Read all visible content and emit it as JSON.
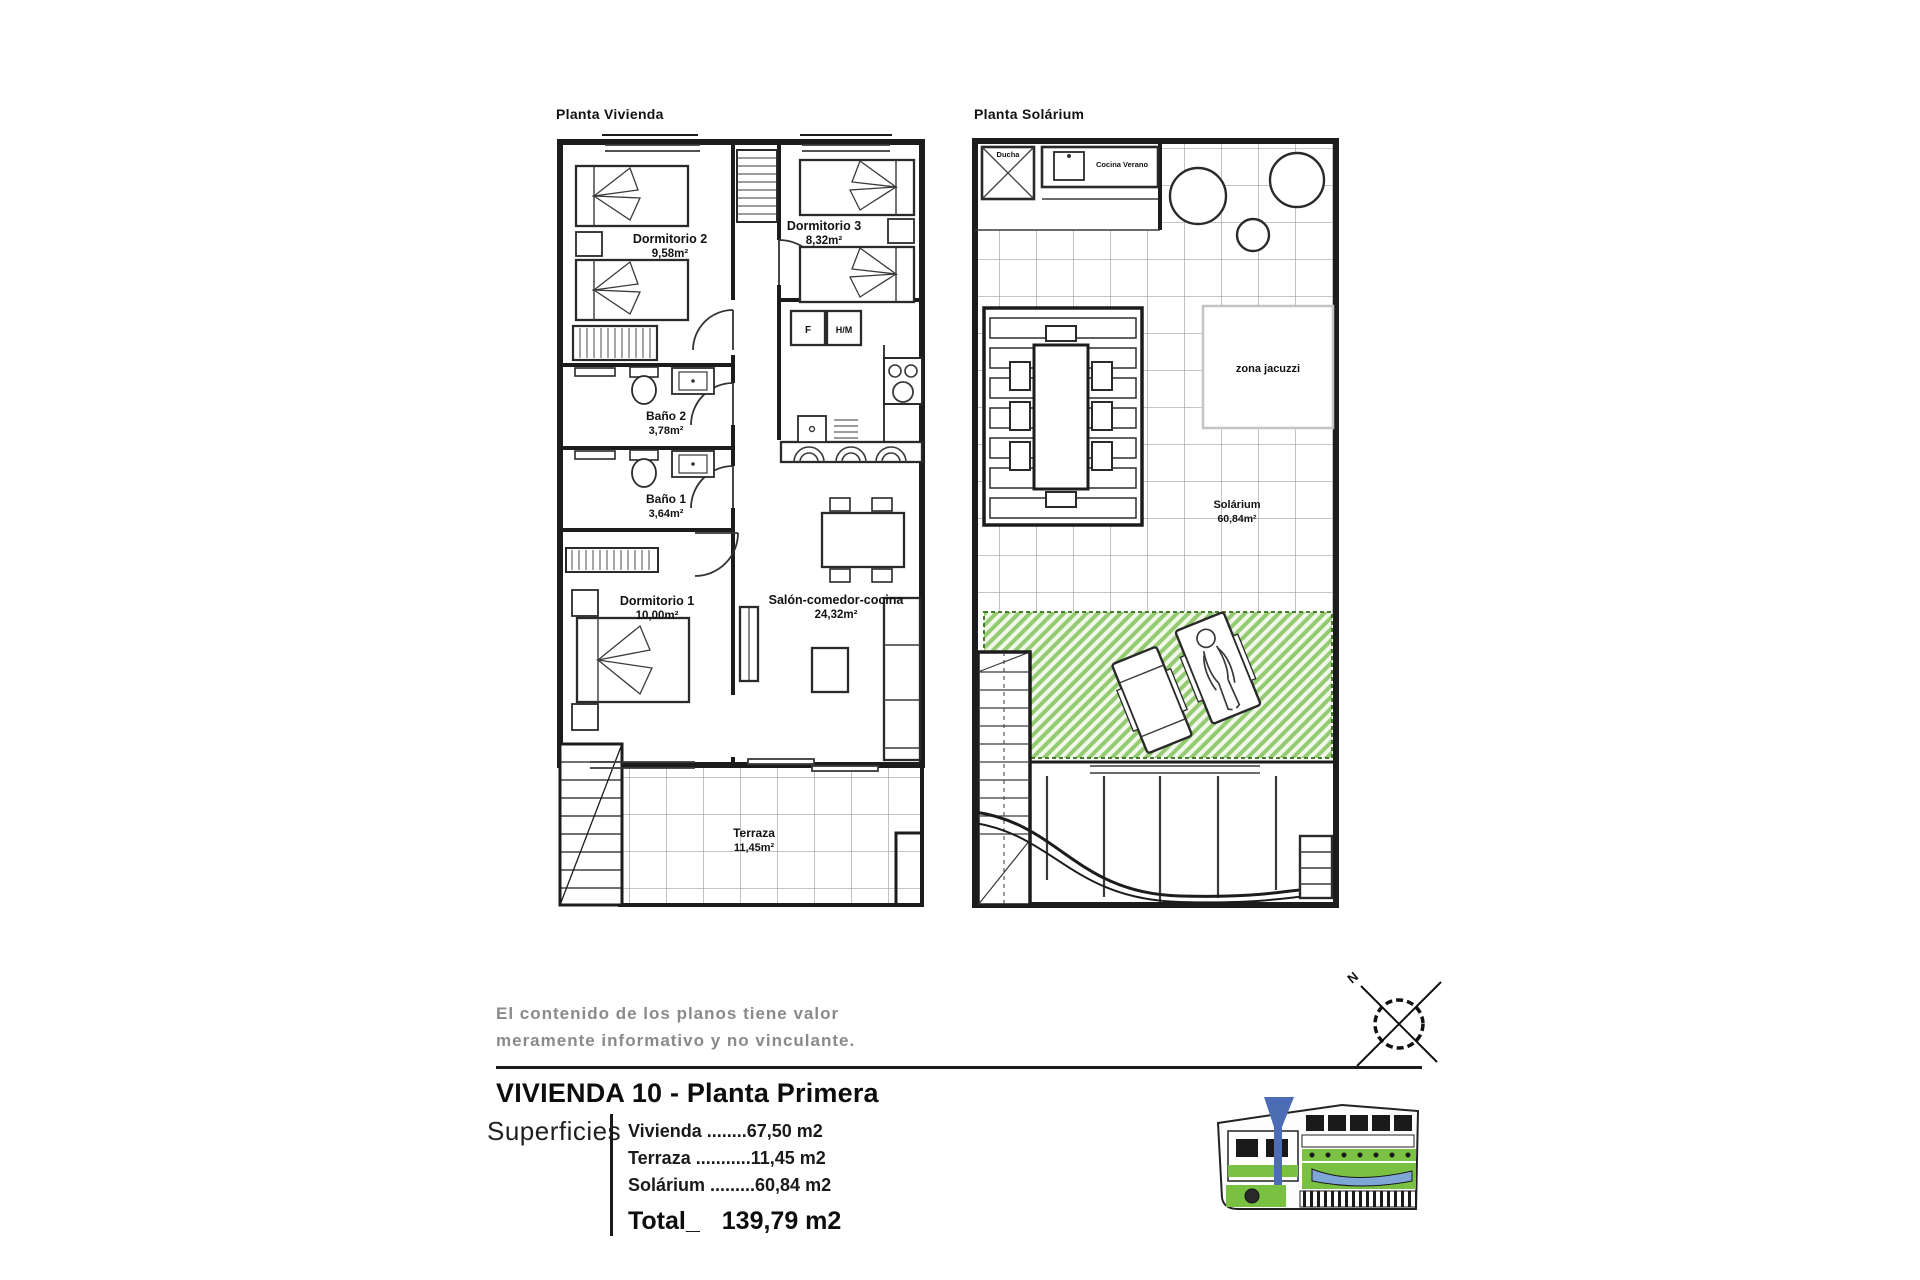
{
  "plans": {
    "vivienda": {
      "title": "Planta Vivienda",
      "rooms": {
        "dormitorio2": {
          "name": "Dormitorio 2",
          "area": "9,58m²"
        },
        "dormitorio3": {
          "name": "Dormitorio 3",
          "area": "8,32m²"
        },
        "bano2": {
          "name": "Baño 2",
          "area": "3,78m²"
        },
        "bano1": {
          "name": "Baño 1",
          "area": "3,64m²"
        },
        "dormitorio1": {
          "name": "Dormitorio 1",
          "area": "10,00m²"
        },
        "salon": {
          "name": "Salón-comedor-cocina",
          "area": "24,32m²"
        },
        "terraza": {
          "name": "Terraza",
          "area": "11,45m²"
        }
      },
      "appliances": {
        "fridge": "F",
        "washer_dryer": "H/M"
      }
    },
    "solarium": {
      "title": "Planta Solárium",
      "labels": {
        "ducha": "Ducha",
        "cocina_verano": "Cocina Verano",
        "zona_jacuzzi": "zona jacuzzi",
        "solarium_name": "Solárium",
        "solarium_area": "60,84m²"
      }
    }
  },
  "disclaimer": {
    "line1": "El contenido de los planos tiene valor",
    "line2": "meramente informativo y no vinculante."
  },
  "title_block": {
    "title": "VIVIENDA 10 - Planta Primera",
    "superficies_label": "Superficies",
    "rows": [
      "Vivienda ........67,50 m2",
      "Terraza ...........11,45 m2",
      "Solárium .........60,84 m2"
    ],
    "total_label": "Total_",
    "total_value": "139,79 m2"
  },
  "compass": {
    "north": "N"
  },
  "colors": {
    "line": "#1c1c1c",
    "grid": "#a0a0a0",
    "green_hatch": "#94cb72",
    "green_border": "#4a7c2f",
    "marker_blue": "#4c6cb3",
    "pool_blue": "#7ea7d8",
    "site_green": "#7ac143",
    "disclaimer_gray": "#8a8a8a"
  }
}
